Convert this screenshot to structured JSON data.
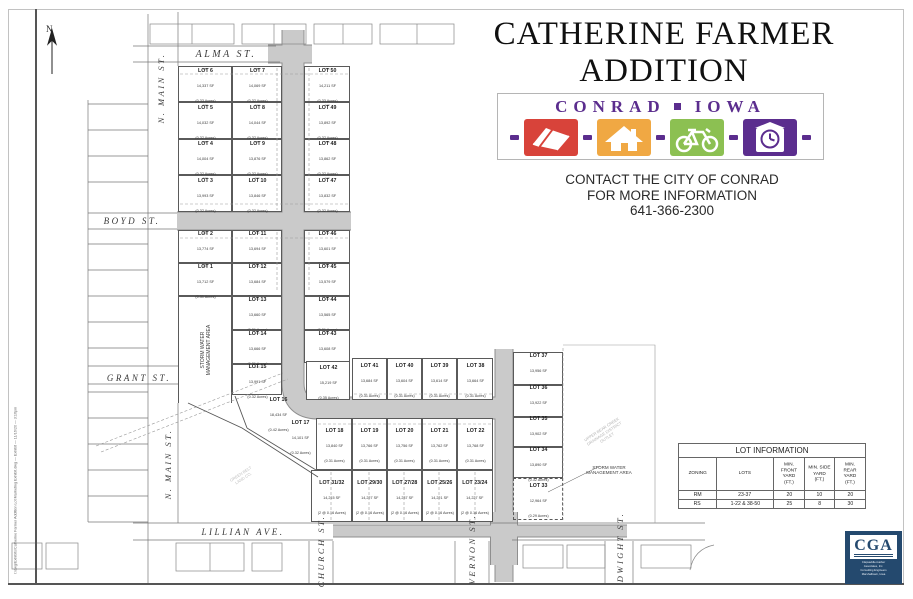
{
  "title": {
    "line1": "CATHERINE FARMER",
    "line2": "ADDITION"
  },
  "logo": {
    "city": "CONRAD",
    "state": "IOWA",
    "colors": {
      "purple": "#5b2d8e",
      "red": "#d8433a",
      "orange": "#f0a843",
      "green": "#8cc052"
    },
    "tiles": [
      "book-icon",
      "house-icon",
      "bicycle-icon",
      "clock-tower-icon"
    ]
  },
  "contact": {
    "line1": "CONTACT THE CITY OF CONRAD",
    "line2": "FOR MORE INFORMATION",
    "phone": "641-366-2300"
  },
  "lot_table": {
    "title": "LOT INFORMATION",
    "headers": [
      "ZONING",
      "LOTS",
      "MIN. FRONT\nYARD (FT.)",
      "MIN. SIDE\nYARD (FT.)",
      "MIN. REAR\nYARD (FT.)"
    ],
    "rows": [
      [
        "RM",
        "23-37",
        "20",
        "10",
        "20"
      ],
      [
        "RS",
        "1-22 & 38-50",
        "25",
        "8",
        "30"
      ]
    ]
  },
  "cga": {
    "abbr": "CGA",
    "caption_lines": [
      "Clapsaddle-Garber Associates, Inc.",
      "Consulting Engineers",
      "Marshalltown, Iowa"
    ]
  },
  "stamp": "I:/dwg/Exhibits/Catherine Farmer Addition Lot Marketing Exhibit.dwg — Exhibit — 11/16/20 — 3:16pm",
  "map": {
    "north_label": "N",
    "street_labels": [
      {
        "text": "ALMA  ST.",
        "x": 226,
        "y": 54,
        "rot": 0,
        "size": 10
      },
      {
        "text": "BOYD  ST.",
        "x": 132,
        "y": 221,
        "rot": 0,
        "size": 9
      },
      {
        "text": "GRANT  ST.",
        "x": 139,
        "y": 378,
        "rot": 0,
        "size": 9
      },
      {
        "text": "LILLIAN  AVE.",
        "x": 243,
        "y": 532,
        "rot": 0,
        "size": 9
      },
      {
        "text": "N.  MAIN  ST.",
        "x": 161,
        "y": 88,
        "rot": -90,
        "size": 8.5
      },
      {
        "text": "N.  MAIN  ST.",
        "x": 168,
        "y": 464,
        "rot": -90,
        "size": 8.5
      },
      {
        "text": "CHURCH ST.",
        "x": 321,
        "y": 551,
        "rot": -90,
        "size": 8.5
      },
      {
        "text": "VERNON ST.",
        "x": 472,
        "y": 549,
        "rot": -90,
        "size": 8.5
      },
      {
        "text": "DWIGHT ST.",
        "x": 620,
        "y": 547,
        "rot": -90,
        "size": 8.5
      }
    ],
    "annotations": [
      {
        "text": "STORM WATER\nMANAGEMENT AREA",
        "x": 206,
        "y": 350,
        "rot": -90,
        "size": 5,
        "color": "#3c3c3c"
      },
      {
        "text": "STORM WATER\nMANAGEMENT AREA",
        "x": 609,
        "y": 470,
        "rot": 0,
        "size": 4.5,
        "color": "#3c3c3c"
      },
      {
        "text": "UPPER BEAR CREEK\nDRAINAGE DISTRICT\nOUTLET",
        "x": 604,
        "y": 433,
        "rot": -33,
        "size": 4,
        "color": "#b5b5b5"
      },
      {
        "text": "GREEN BELT\nLAND CO.",
        "x": 242,
        "y": 476,
        "rot": -33,
        "size": 4,
        "color": "#c0c0c0"
      }
    ],
    "lots": [
      {
        "n": "LOT 6",
        "a1": "14,337 SF",
        "a2": "(0.33 Acres)",
        "x": 178,
        "y": 66,
        "w": 54,
        "h": 36,
        "d": "140"
      },
      {
        "n": "LOT 7",
        "a1": "14,069 SF",
        "a2": "(0.32 Acres)",
        "x": 232,
        "y": 66,
        "w": 50,
        "h": 36,
        "d": "140"
      },
      {
        "n": "LOT 50",
        "a1": "14,211 SF",
        "a2": "(0.33 Acres)",
        "x": 304,
        "y": 66,
        "w": 46,
        "h": 36,
        "d": "140"
      },
      {
        "n": "LOT 5",
        "a1": "14,032 SF",
        "a2": "(0.32 Acres)",
        "x": 178,
        "y": 102,
        "w": 54,
        "h": 37,
        "d": "142"
      },
      {
        "n": "LOT 8",
        "a1": "14,044 SF",
        "a2": "(0.32 Acres)",
        "x": 232,
        "y": 102,
        "w": 50,
        "h": 37,
        "d": "142"
      },
      {
        "n": "LOT 49",
        "a1": "13,892 SF",
        "a2": "(0.32 Acres)",
        "x": 304,
        "y": 102,
        "w": 46,
        "h": 37,
        "d": "140"
      },
      {
        "n": "LOT 4",
        "a1": "14,004 SF",
        "a2": "(0.32 Acres)",
        "x": 178,
        "y": 139,
        "w": 54,
        "h": 36,
        "d": "142"
      },
      {
        "n": "LOT 9",
        "a1": "13,876 SF",
        "a2": "(0.32 Acres)",
        "x": 232,
        "y": 139,
        "w": 50,
        "h": 36,
        "d": "144"
      },
      {
        "n": "LOT 48",
        "a1": "13,862 SF",
        "a2": "(0.32 Acres)",
        "x": 304,
        "y": 139,
        "w": 46,
        "h": 36,
        "d": "140"
      },
      {
        "n": "LOT 3",
        "a1": "13,993 SF",
        "a2": "(0.32 Acres)",
        "x": 178,
        "y": 175,
        "w": 54,
        "h": 37,
        "d": "142"
      },
      {
        "n": "LOT 10",
        "a1": "13,846 SF",
        "a2": "(0.32 Acres)",
        "x": 232,
        "y": 175,
        "w": 50,
        "h": 37,
        "d": "144"
      },
      {
        "n": "LOT 47",
        "a1": "13,832 SF",
        "a2": "(0.32 Acres)",
        "x": 304,
        "y": 175,
        "w": 46,
        "h": 37,
        "d": "140"
      },
      {
        "n": "LOT 2",
        "a1": "13,774 SF",
        "a2": "(0.32 Acres)",
        "x": 178,
        "y": 230,
        "w": 54,
        "h": 33,
        "d": "140"
      },
      {
        "n": "LOT 11",
        "a1": "13,694 SF",
        "a2": "(0.31 Acres)",
        "x": 232,
        "y": 230,
        "w": 50,
        "h": 33,
        "d": "144"
      },
      {
        "n": "LOT 46",
        "a1": "13,601 SF",
        "a2": "(0.31 Acres)",
        "x": 304,
        "y": 230,
        "w": 46,
        "h": 33,
        "d": "132"
      },
      {
        "n": "LOT 1",
        "a1": "13,712 SF",
        "a2": "(0.31 Acres)",
        "x": 178,
        "y": 263,
        "w": 54,
        "h": 33,
        "d": "140"
      },
      {
        "n": "LOT 12",
        "a1": "13,684 SF",
        "a2": "(0.31 Acres)",
        "x": 232,
        "y": 263,
        "w": 50,
        "h": 33,
        "d": "144"
      },
      {
        "n": "LOT 45",
        "a1": "13,579 SF",
        "a2": "(0.31 Acres)",
        "x": 304,
        "y": 263,
        "w": 46,
        "h": 33,
        "d": "132"
      },
      {
        "n": "LOT 13",
        "a1": "13,660 SF",
        "a2": "(0.31 Acres)",
        "x": 232,
        "y": 296,
        "w": 50,
        "h": 34,
        "d": "144"
      },
      {
        "n": "LOT 44",
        "a1": "13,565 SF",
        "a2": "(0.31 Acres)",
        "x": 304,
        "y": 296,
        "w": 46,
        "h": 34,
        "d": "132"
      },
      {
        "n": "LOT 14",
        "a1": "13,666 SF",
        "a2": "(0.31 Acres)",
        "x": 232,
        "y": 330,
        "w": 50,
        "h": 34,
        "d": "144"
      },
      {
        "n": "LOT 43",
        "a1": "13,608 SF",
        "a2": "(0.31 Acres)",
        "x": 304,
        "y": 330,
        "w": 46,
        "h": 33,
        "d": "132"
      },
      {
        "n": "LOT 15",
        "a1": "13,991 SF",
        "a2": "(0.32 Acres)",
        "x": 232,
        "y": 364,
        "w": 50,
        "h": 31,
        "d": "144"
      },
      {
        "n": "LOT 42",
        "a1": "15,219 SF",
        "a2": "(0.35 Acres)",
        "x": 306,
        "y": 361,
        "w": 44,
        "h": 39
      },
      {
        "n": "LOT 41",
        "a1": "13,684 SF",
        "a2": "(0.31 Acres)",
        "x": 352,
        "y": 358,
        "w": 35,
        "h": 42
      },
      {
        "n": "LOT 40",
        "a1": "13,604 SF",
        "a2": "(0.31 Acres)",
        "x": 387,
        "y": 358,
        "w": 35,
        "h": 42
      },
      {
        "n": "LOT 39",
        "a1": "13,614 SF",
        "a2": "(0.31 Acres)",
        "x": 422,
        "y": 358,
        "w": 35,
        "h": 42
      },
      {
        "n": "LOT 38",
        "a1": "13,664 SF",
        "a2": "(0.31 Acres)",
        "x": 457,
        "y": 358,
        "w": 36,
        "h": 42
      },
      {
        "n": "LOT 16",
        "a1": "18,434 SF",
        "a2": "(0.42 Acres)",
        "x": 252,
        "y": 400,
        "w": 52,
        "h": 26,
        "cls": "noborder"
      },
      {
        "n": "LOT 17",
        "a1": "14,101 SF",
        "a2": "(0.32 Acres)",
        "x": 276,
        "y": 424,
        "w": 48,
        "h": 24,
        "cls": "noborder"
      },
      {
        "n": "LOT 18",
        "a1": "13,840 SF",
        "a2": "(0.31 Acres)",
        "x": 316,
        "y": 418,
        "w": 36,
        "h": 52
      },
      {
        "n": "LOT 19",
        "a1": "13,766 SF",
        "a2": "(0.31 Acres)",
        "x": 352,
        "y": 418,
        "w": 35,
        "h": 52
      },
      {
        "n": "LOT 20",
        "a1": "13,756 SF",
        "a2": "(0.31 Acres)",
        "x": 387,
        "y": 418,
        "w": 35,
        "h": 52
      },
      {
        "n": "LOT 21",
        "a1": "13,762 SF",
        "a2": "(0.31 Acres)",
        "x": 422,
        "y": 418,
        "w": 35,
        "h": 52
      },
      {
        "n": "LOT 22",
        "a1": "13,768 SF",
        "a2": "(0.31 Acres)",
        "x": 457,
        "y": 418,
        "w": 36,
        "h": 52
      },
      {
        "n": "LOT 31/32",
        "a1": "14,215 SF",
        "a2": "(2 @ 0.16 Acres)",
        "x": 311,
        "y": 470,
        "w": 41,
        "h": 52
      },
      {
        "n": "LOT 29/30",
        "a1": "14,227 SF",
        "a2": "(2 @ 0.16 Acres)",
        "x": 352,
        "y": 470,
        "w": 35,
        "h": 52
      },
      {
        "n": "LOT 27/28",
        "a1": "14,237 SF",
        "a2": "(2 @ 0.16 Acres)",
        "x": 387,
        "y": 470,
        "w": 35,
        "h": 52
      },
      {
        "n": "LOT 25/26",
        "a1": "14,221 SF",
        "a2": "(2 @ 0.16 Acres)",
        "x": 422,
        "y": 470,
        "w": 35,
        "h": 52
      },
      {
        "n": "LOT 23/24",
        "a1": "14,227 SF",
        "a2": "(2 @ 0.16 Acres)",
        "x": 457,
        "y": 470,
        "w": 36,
        "h": 52
      },
      {
        "n": "LOT 37",
        "a1": "13,956 SF",
        "a2": "(0.32 Acres)",
        "x": 513,
        "y": 352,
        "w": 50,
        "h": 33
      },
      {
        "n": "LOT 36",
        "a1": "13,922 SF",
        "a2": "(0.32 Acres)",
        "x": 513,
        "y": 385,
        "w": 50,
        "h": 32
      },
      {
        "n": "LOT 35",
        "a1": "13,902 SF",
        "a2": "(0.32 Acres)",
        "x": 513,
        "y": 417,
        "w": 50,
        "h": 30
      },
      {
        "n": "LOT 34",
        "a1": "13,890 SF",
        "a2": "(0.32 Acres)",
        "x": 513,
        "y": 447,
        "w": 50,
        "h": 31
      },
      {
        "n": "LOT 33",
        "a1": "12,964 SF",
        "a2": "(0.29 Acres)",
        "x": 513,
        "y": 478,
        "w": 50,
        "h": 42,
        "cls": "dashed"
      }
    ]
  }
}
